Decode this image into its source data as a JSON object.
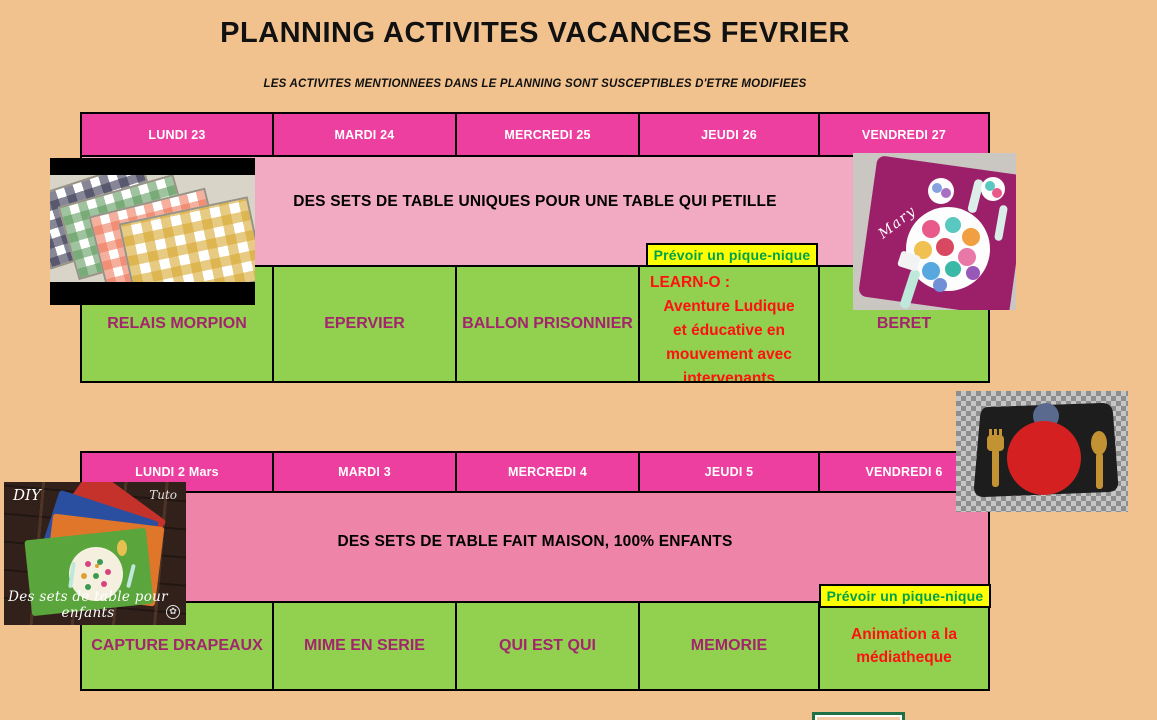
{
  "title": "PLANNING ACTIVITES VACANCES FEVRIER",
  "subtitle": "LES ACTIVITES MENTIONNEES DANS LE PLANNING SONT SUSCEPTIBLES D'ETRE MODIFIEES",
  "colors": {
    "background": "#f2c28e",
    "day_header": "#ec3fa0",
    "banner_week1": "#f2a9c2",
    "banner_week2": "#ee84a7",
    "activity_cell": "#92d050",
    "activity_text": "#a3256e",
    "highlight_text": "#ff1111",
    "note_background": "#ffff00",
    "note_text": "#00a14e"
  },
  "week1": {
    "days": [
      "LUNDI 23",
      "MARDI 24",
      "MERCREDI 25",
      "JEUDI 26",
      "VENDREDI 27"
    ],
    "banner": "DES SETS DE TABLE UNIQUES POUR UNE TABLE QUI PETILLE",
    "note": "Prévoir un pique-nique",
    "activities": [
      {
        "label": "RELAIS MORPION"
      },
      {
        "label": "EPERVIER"
      },
      {
        "label": "BALLON PRISONNIER"
      },
      {
        "label": "LEARN-O :",
        "details": "Aventure Ludique\net éducative en\nmouvement avec\nintervenants"
      },
      {
        "label": "BERET"
      }
    ]
  },
  "week2": {
    "days": [
      "LUNDI 2 Mars",
      "MARDI 3",
      "MERCREDI 4",
      "JEUDI 5",
      "VENDREDI 6"
    ],
    "banner": "DES SETS DE TABLE FAIT MAISON, 100% ENFANTS",
    "note": "Prévoir un pique-nique",
    "activities": [
      {
        "label": "CAPTURE DRAPEAUX"
      },
      {
        "label": "MIME EN SERIE"
      },
      {
        "label": "QUI EST QUI"
      },
      {
        "label": "MEMORIE"
      },
      {
        "label": "Animation a la\nmédiatheque"
      }
    ]
  },
  "images": {
    "mary_placemat": {
      "label": "Mary"
    },
    "diy_placemats": {
      "badge_left": "DIY",
      "badge_right": "Tuto",
      "caption": "Des sets de table pour enfants"
    }
  }
}
